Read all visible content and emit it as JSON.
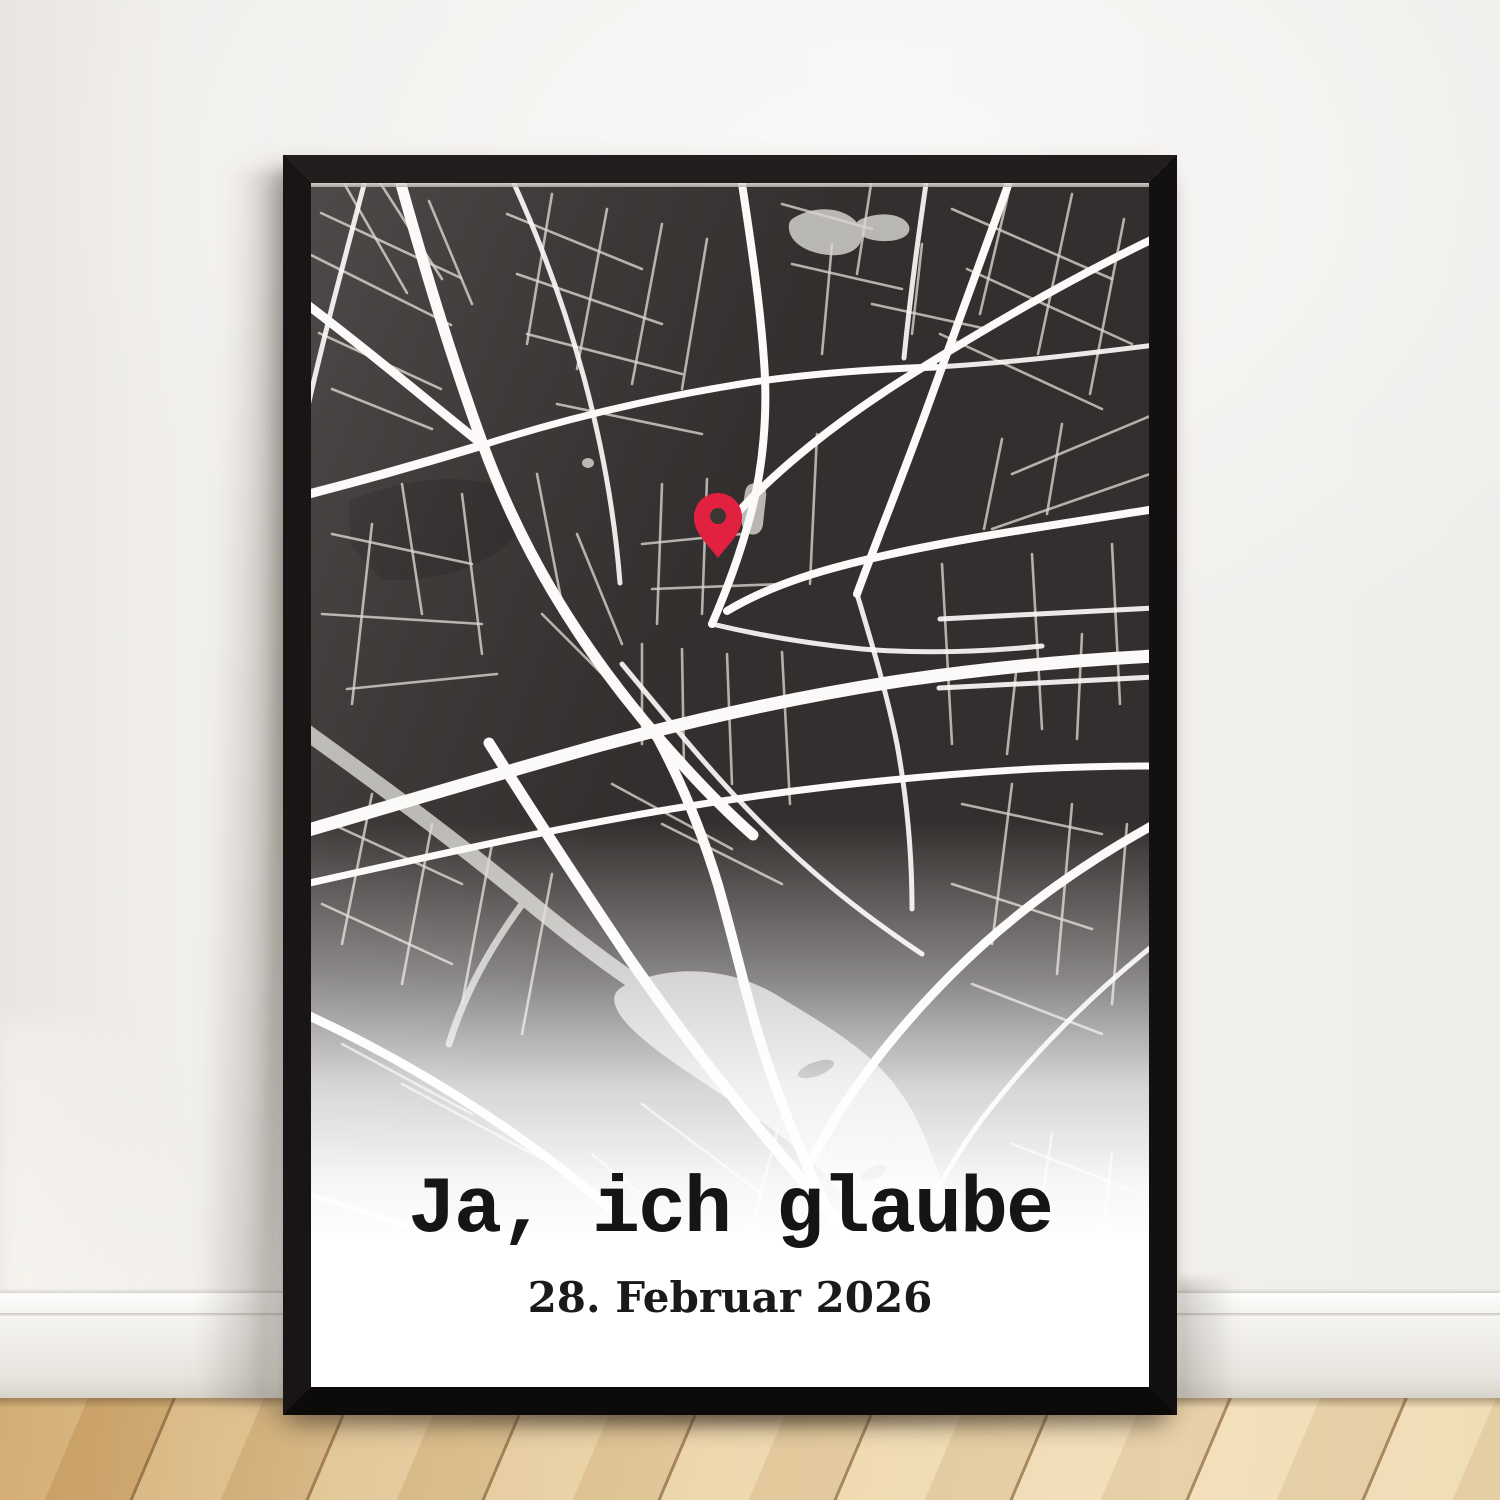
{
  "poster": {
    "title": "Ja, ich glaube",
    "date": "28. Februar 2026",
    "title_color": "#171513",
    "date_color": "#1c1a18",
    "background": "#ffffff"
  },
  "scene": {
    "wall_color": "#f1efec",
    "baseboard_color": "#f7f6f3",
    "floor_light": "#ebd3a6",
    "floor_dark": "#cda163",
    "frame_color": "#141212"
  },
  "map": {
    "background": "#332F2E",
    "park_color": "#2a2726",
    "major_road_color": "#fbfaf8",
    "minor_road_color": "#d8d5d1",
    "water_color": "#b9b7b4",
    "pin": {
      "x": 407,
      "y": 375,
      "color": "#e2203f",
      "hole_color": "#3a3633"
    },
    "park": "M 38 318 C 90 296 150 288 196 306 L 206 352 C 180 382 120 402 70 396 L 40 362 Z",
    "water_strokes": [
      {
        "d": "M -6 548 C 80 610 150 662 215 716 C 281 771 331 806 386 839",
        "w": 16
      },
      {
        "d": "M 215 716 C 181 761 153 811 138 861",
        "w": 7
      }
    ],
    "water_fills": [
      "M 320 800 C 372 778 432 789 472 816 C 522 846 562 871 587 906 C 617 946 622 986 642 1021 C 662 1061 682 1096 702 1131 C 712 1161 702 1186 682 1196 C 652 1201 622 1186 602 1151 C 577 1106 562 1061 537 1021 C 507 976 462 946 417 916 C 372 886 332 861 312 836 C 297 816 302 806 320 800 Z",
      "M 488 32 C 514 20 542 28 550 46 C 555 62 541 74 518 72 C 495 70 479 59 478 46 C 477 38 480 36 488 32 Z",
      "M 556 34 C 576 28 594 33 598 43 C 601 53 588 59 570 58 C 553 57 543 50 545 42 C 546 37 550 36 556 34 Z",
      "M 440 301 C 453 297 456 306 455 314 L 452 341 C 451 352 441 354 435 349 C 430 344 430 337 431 329 L 434 309 C 435 304 437 302 440 301 Z",
      "M 271 280 a 6 5 0 1 0 12 0 a 6 5 0 1 0 -12 0 Z"
    ],
    "islands": [
      {
        "cx": 505,
        "cy": 886,
        "rx": 19,
        "ry": 7,
        "rot": -20
      },
      {
        "cx": 563,
        "cy": 990,
        "rx": 14,
        "ry": 6,
        "rot": -25
      }
    ],
    "roads_major": [
      {
        "d": "M 88 -6 C 112 80 138 168 172 262 C 208 360 262 455 345 552 C 378 590 408 622 442 652",
        "w": 11
      },
      {
        "d": "M -6 648 C 90 620 190 590 290 562 C 390 535 495 512 595 497 C 685 484 765 477 844 473",
        "w": 13
      },
      {
        "d": "M 345 552 C 372 602 392 652 407 702 C 427 772 441 842 466 907 C 491 977 521 1042 561 1102 C 586 1142 612 1172 642 1205",
        "w": 10
      },
      {
        "d": "M 178 560 C 225 635 271 705 318 775 C 370 850 421 915 481 985 C 541 1055 601 1122 666 1205",
        "w": 11
      },
      {
        "d": "M 430 -6 C 440 60 449 120 453 178 C 457 230 452 285 440 330 C 429 372 416 406 401 441",
        "w": 8
      },
      {
        "d": "M 700 -6 C 672 70 645 145 618 220 C 591 295 566 356 546 411",
        "w": 8
      },
      {
        "d": "M 844 55 C 761 95 681 141 601 191 C 521 241 461 291 421 336",
        "w": 8
      },
      {
        "d": "M 844 326 C 751 341 656 354 576 372 C 516 385 461 401 416 428",
        "w": 8
      },
      {
        "d": "M -6 120 C 58 168 114 216 172 262",
        "w": 9
      },
      {
        "d": "M -6 312 C 56 296 116 279 172 262",
        "w": 9
      },
      {
        "d": "M 172 262 C 262 233 352 213 442 199 C 505 190 565 186 625 184",
        "w": 7
      },
      {
        "d": "M 844 641 C 771 681 701 731 641 791 C 581 851 531 916 496 986",
        "w": 9
      },
      {
        "d": "M -6 831 C 60 861 131 901 196 946 C 261 991 321 1041 376 1096 C 416 1136 451 1171 481 1205",
        "w": 9
      },
      {
        "d": "M -6 701 C 120 673 240 646 360 626 C 480 606 600 593 721 586 C 762 584 802 583 844 583",
        "w": 7
      }
    ],
    "roads_mid": [
      "M 401 441 C 451 453 501 461 551 466 C 611 471 671 469 731 463",
      "M 546 411 C 561 461 576 511 586 561 C 596 616 601 671 601 726",
      "M 311 481 C 361 541 401 591 451 641 C 501 691 551 731 611 771",
      "M 844 761 C 781 811 721 871 671 936 C 631 991 601 1051 581 1111",
      "M -6 1011 C 70 1031 151 1061 226 1101 C 291 1136 351 1171 406 1205",
      "M 55 -6 L 22 120 C 12 160 2 200 -6 236",
      "M 625 184 C 695 180 765 172 844 162",
      "M 200 -6 C 258 120 298 260 309 400",
      "M 616 -6 C 607 55 599 115 593 175",
      "M 844 425 L 629 436",
      "M 628 505 L 844 494"
    ],
    "roads_minor": [
      "M 10 30 L 150 95",
      "M 0 72 L 140 142",
      "M 8 150 L 130 206",
      "M 30 -5 L 96 110",
      "M 66 -5 L 131 96",
      "M 118 18 L 161 121",
      "M 21 206 L 121 246",
      "M 196 31 L 331 86",
      "M 206 91 L 351 141",
      "M 216 151 L 371 191",
      "M 241 11 L 216 161",
      "M 296 26 L 266 186",
      "M 351 41 L 321 201",
      "M 396 56 L 371 206",
      "M 471 21 L 561 46",
      "M 481 81 L 591 106",
      "M 561 -5 L 546 91",
      "M 611 61 L 601 151",
      "M 641 26 L 801 96",
      "M 656 86 L 821 161",
      "M 629 151 L 791 226",
      "M 701 -5 L 669 131",
      "M 761 11 L 727 171",
      "M 813 36 L 779 211",
      "M 844 231 L 701 291",
      "M 839 291 L 681 346",
      "M 751 241 L 736 331",
      "M 691 256 L 673 346",
      "M 21 351 L 161 381",
      "M 11 431 L 171 441",
      "M 36 506 L 186 491",
      "M 91 301 L 111 431",
      "M 151 311 L 171 471",
      "M 226 291 L 251 421",
      "M 61 341 L 41 521",
      "M 231 431 L 321 521",
      "M 331 361 L 431 351",
      "M 341 406 L 471 401",
      "M 351 301 L 346 441",
      "M 396 296 L 391 431",
      "M 506 251 L 499 401",
      "M 331 461 L 331 561",
      "M 371 466 L 373 586",
      "M 416 471 L 421 601",
      "M 471 469 L 479 621",
      "M 351 641 L 471 701",
      "M 301 601 L 421 666",
      "M 631 381 L 641 561",
      "M 721 371 L 731 546",
      "M 801 361 L 809 521",
      "M 651 621 L 791 651",
      "M 701 601 L 681 761",
      "M 761 621 L 746 791",
      "M 816 641 L 801 821",
      "M 641 701 L 781 746",
      "M 661 801 L 791 851",
      "M 21 641 L 151 701",
      "M 11 721 L 141 781",
      "M 61 611 L 31 761",
      "M 121 641 L 91 801",
      "M 181 661 L 151 821",
      "M 241 691 L 211 851",
      "M 31 861 L 161 931",
      "M 91 901 L 231 976",
      "M 331 921 L 451 1011",
      "M 281 971 L 401 1071",
      "M 471 931 L 431 1081",
      "M 521 961 L 491 1111",
      "M 351 1061 L 481 1161",
      "M 241 1061 L 351 1161",
      "M 701 961 L 831 1011",
      "M 681 1031 L 811 1091",
      "M 741 951 L 716 1111",
      "M 801 971 L 781 1141",
      "M 521 61 L 511 171",
      "M 561 121 L 676 146",
      "M 246 221 L 391 251",
      "M 266 351 L 311 461",
      "M 706 481 L 696 571",
      "M 771 451 L 766 556"
    ]
  }
}
